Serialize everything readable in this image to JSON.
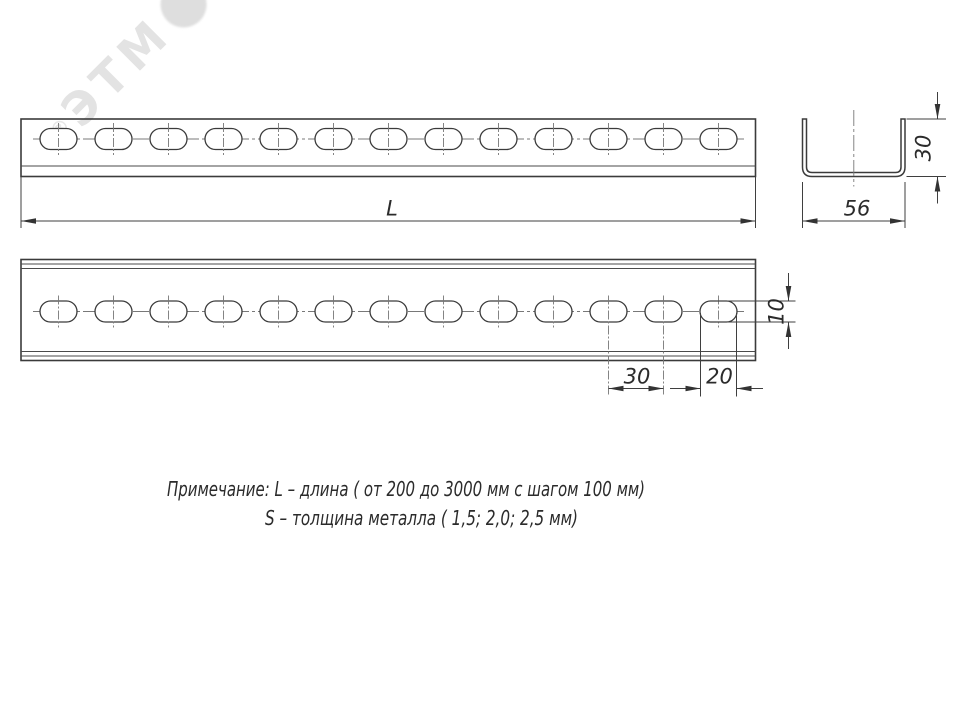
{
  "watermark": {
    "text": "ЭТМ",
    "reg": "®"
  },
  "dims": {
    "length": "L",
    "section_width": "56",
    "section_height": "30",
    "hole_pitch": "30",
    "slot_length": "20",
    "slot_width": "10"
  },
  "note": {
    "line1": "Примечание: L – длина ( от 200 до 3000 мм с шагом 100 мм)",
    "line2": "S – толщина металла ( 1,5; 2,0; 2,5 мм)"
  },
  "geometry": {
    "holes_per_row": 13,
    "first_hole_cx": 58.5,
    "hole_pitch_px": 55,
    "slot_w_px": 37,
    "slot_h_px": 21,
    "row1_cy": 139,
    "row2_cy": 311.5,
    "tick_half": 16,
    "extended_tick_cx": [
      608.5,
      663.5
    ],
    "extended_tick_y2": 396.5
  },
  "colors": {
    "outline": "#3b3b3b",
    "thin": "#4a4a4a",
    "centerline": "#787878",
    "dimension": "#3f3f3f",
    "text": "#2b2b2b",
    "watermark": "#e3e3e3"
  }
}
